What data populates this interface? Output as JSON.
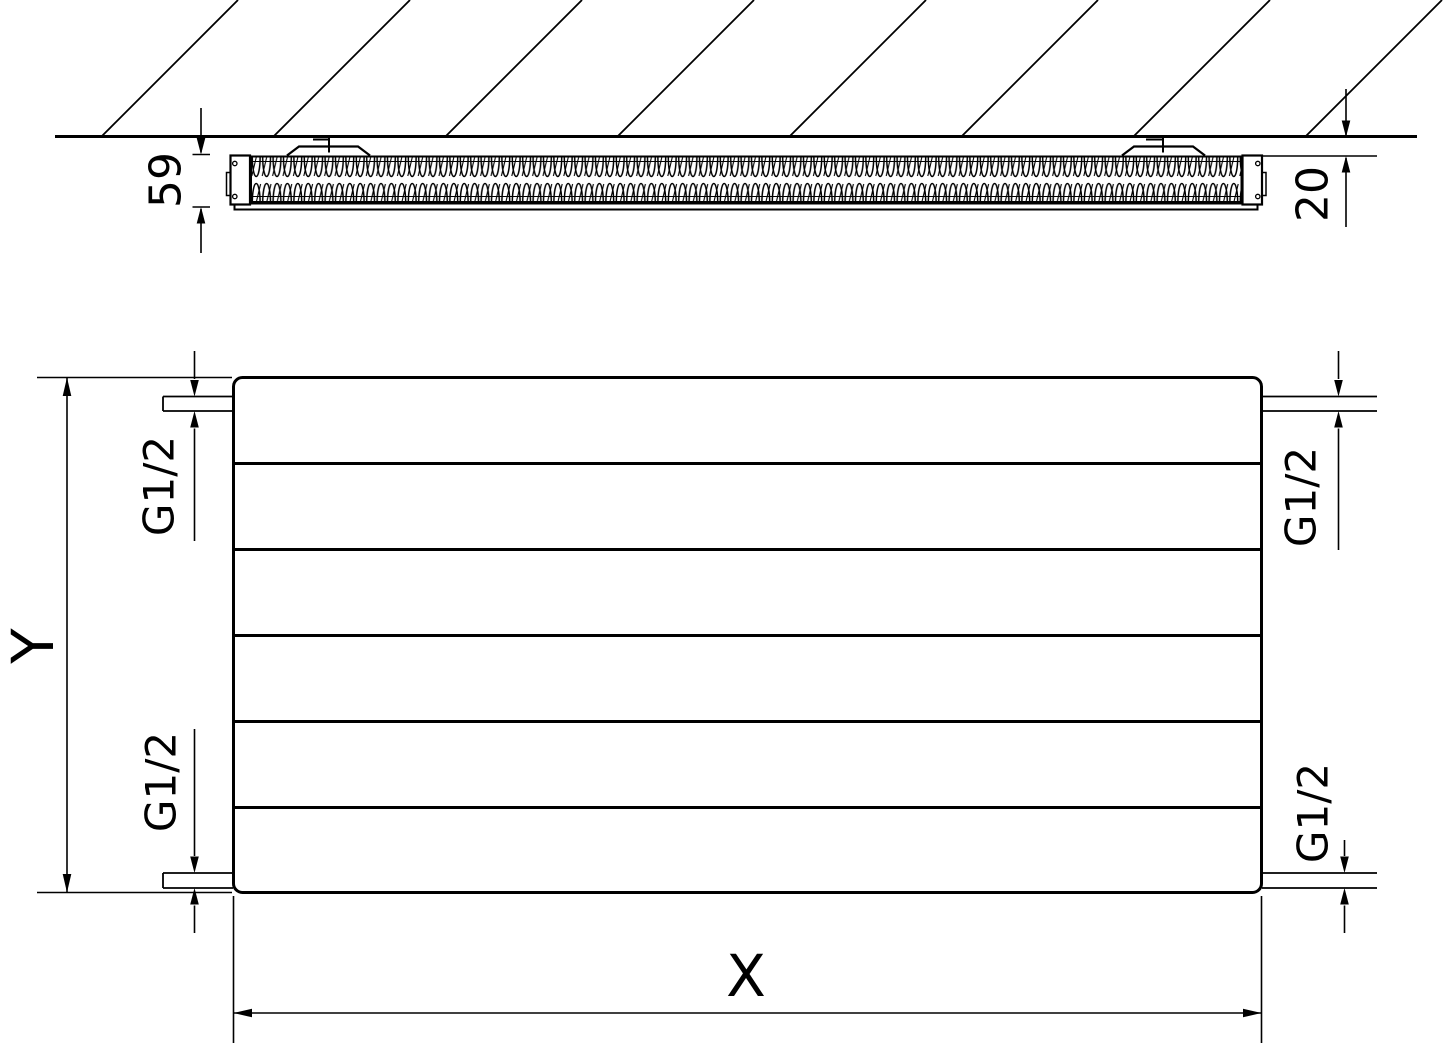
{
  "diagram": {
    "labels": {
      "depth": "59",
      "wall_distance": "20",
      "height_axis": "Y",
      "width_axis": "X",
      "connection_top_left": "G1/2",
      "connection_top_right": "G1/2",
      "connection_bottom_left": "G1/2",
      "connection_bottom_right": "G1/2"
    },
    "colors": {
      "line": "#000000",
      "background": "#ffffff"
    }
  }
}
